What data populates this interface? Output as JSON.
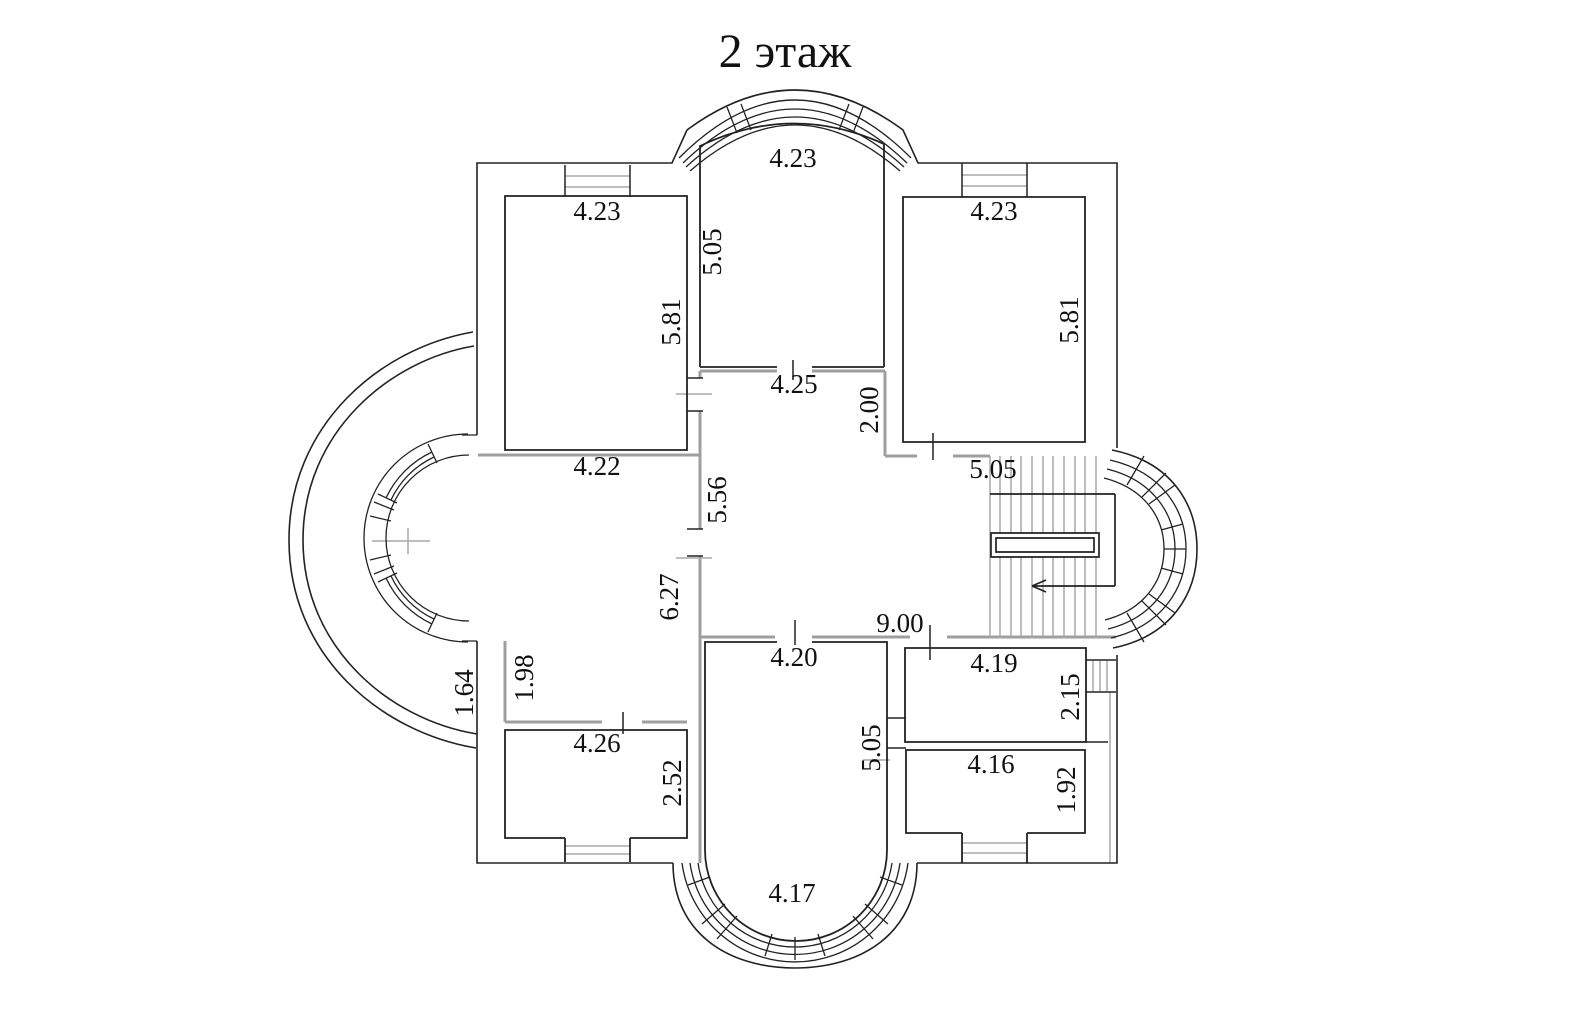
{
  "title": "2 этаж",
  "colors": {
    "line": "#222222",
    "wall_gray": "#9f9f9f",
    "detail_gray": "#a8a8a8",
    "background": "#ffffff"
  },
  "stairs": {
    "arrow_direction": "left"
  },
  "dimension_labels": [
    {
      "text": "4.23",
      "x": 793,
      "y": 158,
      "rot": 0
    },
    {
      "text": "5.05",
      "x": 712,
      "y": 252,
      "rot": -90
    },
    {
      "text": "4.23",
      "x": 597,
      "y": 211,
      "rot": 0
    },
    {
      "text": "5.81",
      "x": 671,
      "y": 322,
      "rot": -90
    },
    {
      "text": "4.23",
      "x": 994,
      "y": 211,
      "rot": 0
    },
    {
      "text": "5.81",
      "x": 1069,
      "y": 320,
      "rot": -90
    },
    {
      "text": "4.25",
      "x": 794,
      "y": 384,
      "rot": 0
    },
    {
      "text": "2.00",
      "x": 869,
      "y": 410,
      "rot": -90
    },
    {
      "text": "5.05",
      "x": 993,
      "y": 469,
      "rot": 0
    },
    {
      "text": "4.22",
      "x": 597,
      "y": 466,
      "rot": 0
    },
    {
      "text": "5.56",
      "x": 717,
      "y": 500,
      "rot": -90
    },
    {
      "text": "6.27",
      "x": 669,
      "y": 597,
      "rot": -90
    },
    {
      "text": "9.00",
      "x": 900,
      "y": 623,
      "rot": 0
    },
    {
      "text": "4.20",
      "x": 794,
      "y": 657,
      "rot": 0
    },
    {
      "text": "4.19",
      "x": 994,
      "y": 663,
      "rot": 0
    },
    {
      "text": "2.15",
      "x": 1070,
      "y": 697,
      "rot": -90
    },
    {
      "text": "1.64",
      "x": 464,
      "y": 693,
      "rot": -90
    },
    {
      "text": "1.98",
      "x": 524,
      "y": 678,
      "rot": -90
    },
    {
      "text": "4.26",
      "x": 597,
      "y": 743,
      "rot": 0
    },
    {
      "text": "2.52",
      "x": 672,
      "y": 783,
      "rot": -90
    },
    {
      "text": "5.05",
      "x": 871,
      "y": 748,
      "rot": -90
    },
    {
      "text": "4.16",
      "x": 991,
      "y": 764,
      "rot": 0
    },
    {
      "text": "1.92",
      "x": 1066,
      "y": 790,
      "rot": -90
    },
    {
      "text": "4.17",
      "x": 792,
      "y": 893,
      "rot": 0
    }
  ]
}
